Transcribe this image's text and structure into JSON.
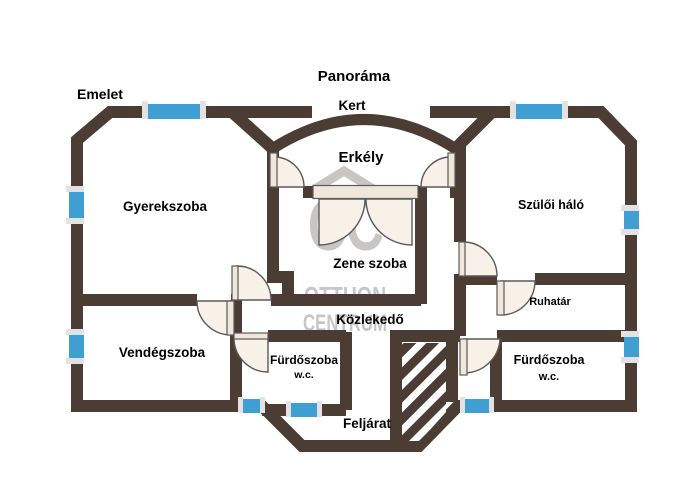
{
  "plan": {
    "floor_label": "Emelet",
    "area_labels": {
      "panorama": "Panoráma",
      "garden": "Kert",
      "balcony": "Erkély",
      "upstairs_entry": "Feljárat"
    },
    "rooms": {
      "childrens_room": "Gyerekszoba",
      "master_bedroom": "Szülői háló",
      "music_room": "Zene szoba",
      "hallway": "Közlekedő",
      "wardrobe": "Ruhatár",
      "guest_room": "Vendégszoba",
      "bathroom_left": "Fürdőszoba",
      "bathroom_left_wc": "w.c.",
      "bathroom_right": "Fürdőszoba",
      "bathroom_right_wc": "w.c."
    },
    "watermark": {
      "logo_text": "OC",
      "line1": "OTTHON",
      "line2": "CENTRUM"
    },
    "colors": {
      "wall": "#4c3d34",
      "window_blue": "#3f9fd2",
      "window_cap": "#e2e2e2",
      "door_fill": "#f8f1e7",
      "door_leaf": "#efe7da",
      "door_stroke": "#5a5a5a",
      "watermark": "#c8c6c4",
      "text": "#000000"
    }
  }
}
